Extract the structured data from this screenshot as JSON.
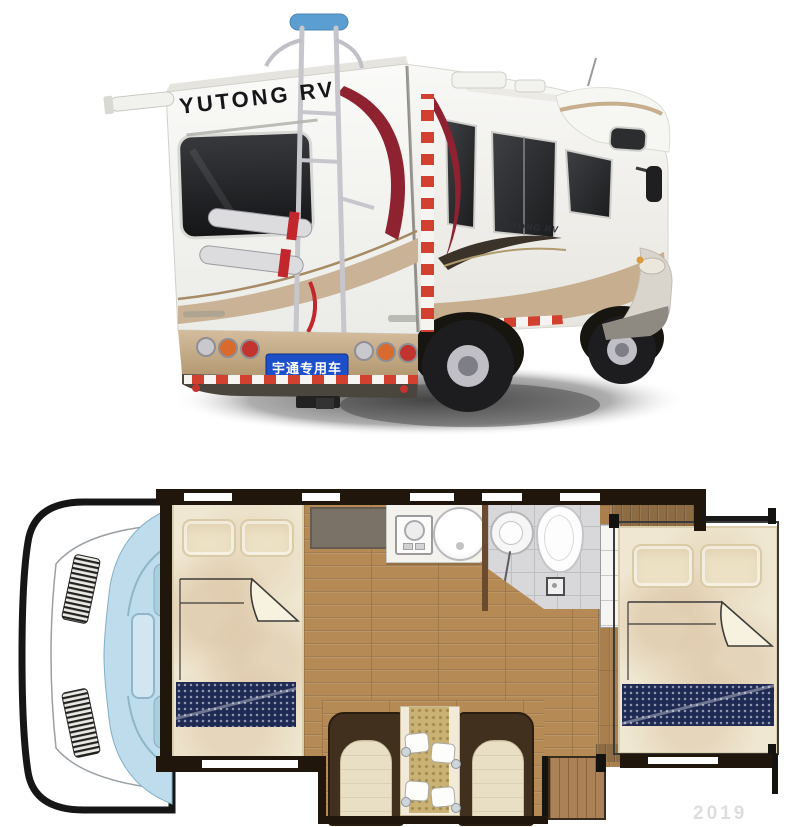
{
  "photo": {
    "rear_logo": "YUTONG RV",
    "side_logo": "YUTONG RV",
    "license_plate_text": "宇通专用车",
    "colors": {
      "body_white": "#f5f4f0",
      "accent_champagne": "#c6ae8e",
      "swoosh_red": "#8e2231",
      "hazard_red": "#d2402f",
      "plate_blue": "#1d50c8",
      "window_dark": "#2b2c2e",
      "bike_rack_silver": "#c6c6cc",
      "rack_grip_blue": "#5b9ed2"
    }
  },
  "floorplan": {
    "colors": {
      "floor_wood": "#b68a55",
      "wall_dark": "#20160c",
      "runner_navy": "#1f2a54",
      "bedding_cream": "#efe7d1",
      "bath_tile": "#d8d8da",
      "cab_glass_blue": "#bedcec",
      "bench_brown": "#40301d",
      "cushion_cream": "#e9dfc5",
      "table_gold": "#c9b273",
      "entry_mat": "#7b7267"
    },
    "features": [
      "driver-cab",
      "front-double-bed",
      "entry-mat",
      "kitchen-counter",
      "gas-stove",
      "round-sink",
      "wet-bathroom",
      "toilet",
      "wash-basin",
      "floor-drain",
      "wardrobe",
      "rear-double-bed",
      "dinette-bench-left",
      "dinette-bench-right",
      "dining-table",
      "place-settings",
      "entry-step"
    ]
  },
  "watermark_text": "2019"
}
